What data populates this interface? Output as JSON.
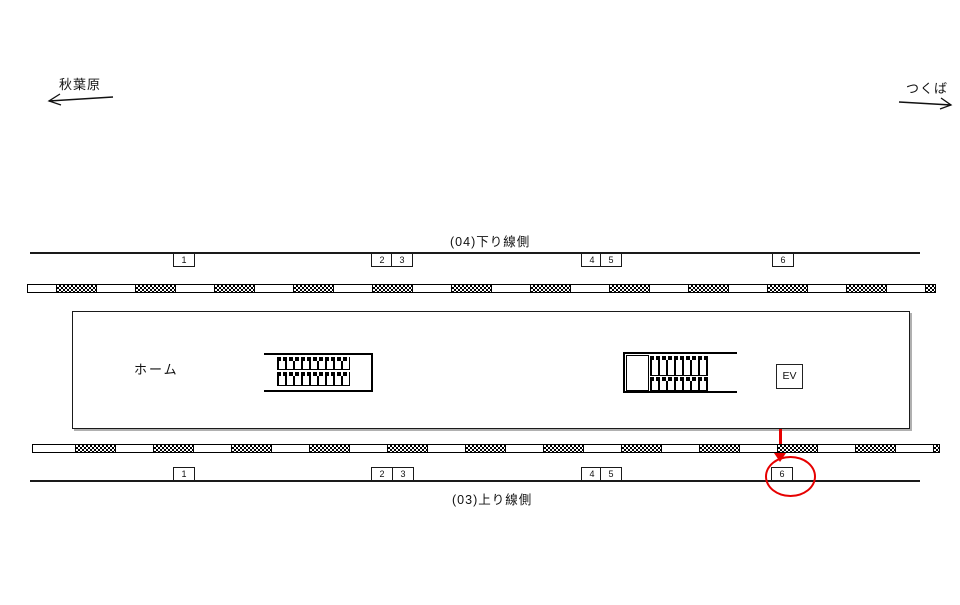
{
  "directions": {
    "left": "秋葉原",
    "right": "つくば"
  },
  "track_top": {
    "label": "(04)下り線側"
  },
  "track_bottom": {
    "label": "(03)上り線側"
  },
  "platform": {
    "label": "ホーム",
    "elevator": "EV"
  },
  "markers_top": [
    "1",
    "2",
    "3",
    "4",
    "5",
    "6"
  ],
  "markers_bottom": [
    "1",
    "2",
    "3",
    "4",
    "5",
    "6"
  ],
  "highlight": {
    "target": "6",
    "color": "#e60000"
  },
  "colors": {
    "ink": "#000000",
    "background": "#ffffff",
    "accent": "#e60000"
  }
}
